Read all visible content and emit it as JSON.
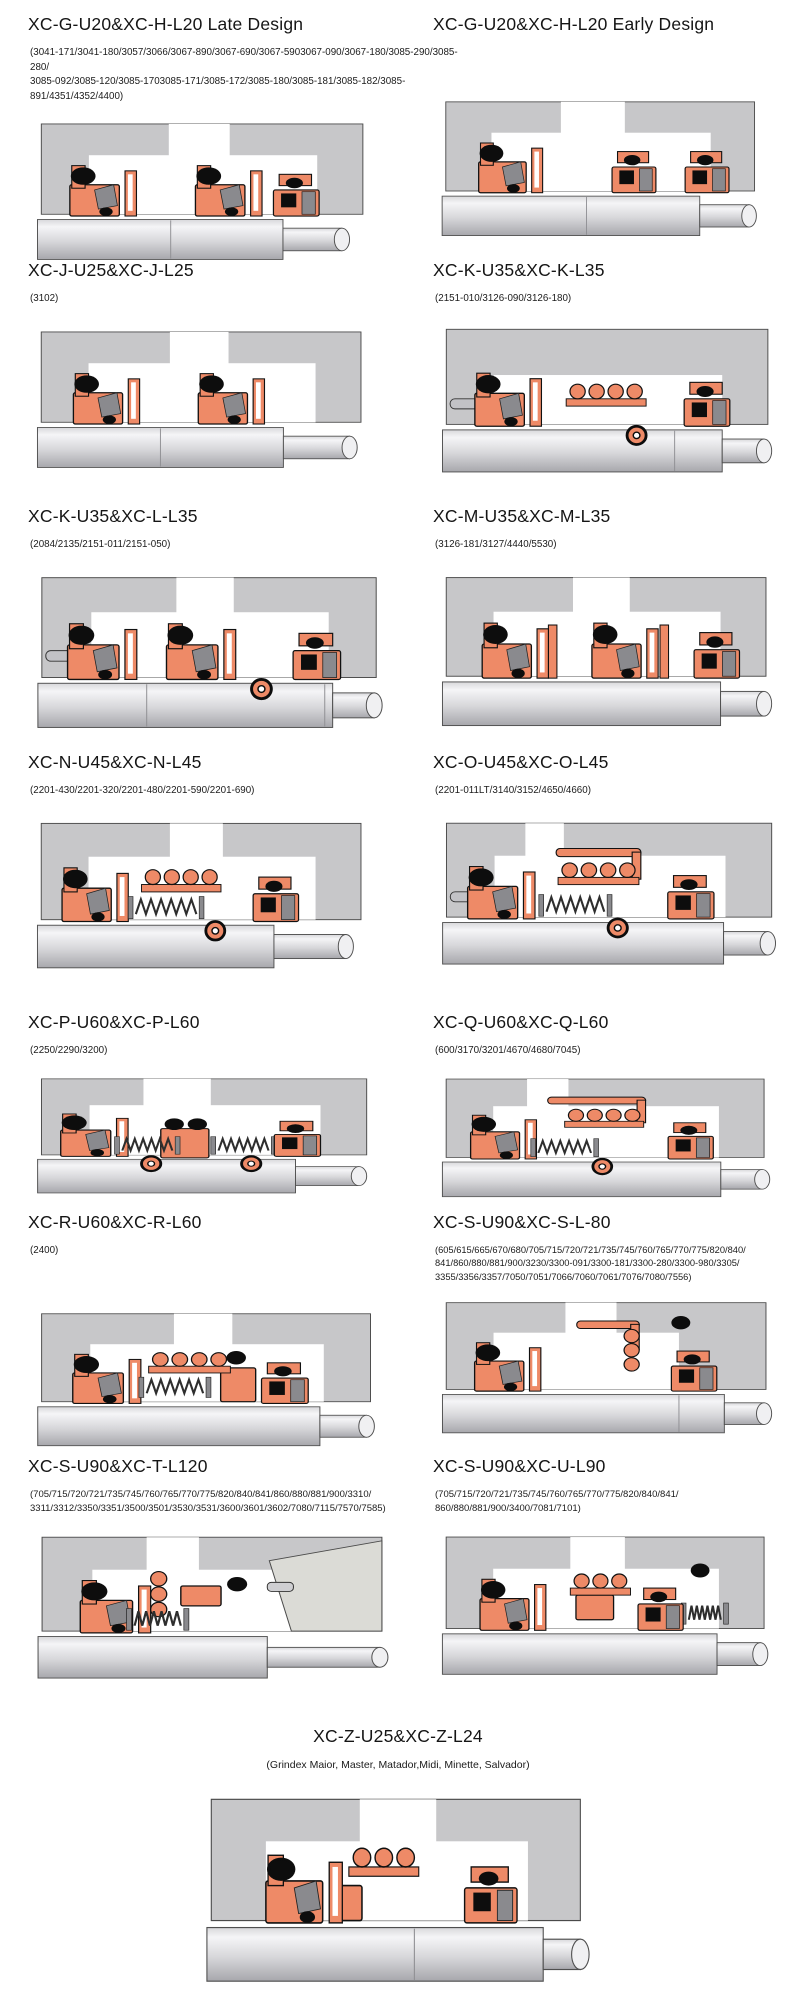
{
  "colors": {
    "housing": "#c7c7c9",
    "seal": "#ee8a67",
    "elastomer": "#0d0d0d",
    "metal": "#8a8a8e",
    "shaft_light": "#f5f5f7",
    "shaft_dark": "#a7a7ac",
    "outline": "#4a4a4a"
  },
  "sections": [
    {
      "title": "XC-G-U20&XC-H-L20 Late Design",
      "parts": "(3041-171/3041-180/3057/3066/3067-890/3067-690/3067-5903067-090/3067-180/3085-290/3085-280/\n3085-092/3085-120/3085-1703085-171/3085-172/3085-180/3085-181/3085-182/3085-891/4351/4352/4400)"
    },
    {
      "title": "XC-G-U20&XC-H-L20 Early Design",
      "parts": ""
    },
    {
      "title": "XC-J-U25&XC-J-L25",
      "parts": "(3102)"
    },
    {
      "title": "XC-K-U35&XC-K-L35",
      "parts": "(2151-010/3126-090/3126-180)"
    },
    {
      "title": "XC-K-U35&XC-L-L35",
      "parts": "(2084/2135/2151-011/2151-050)"
    },
    {
      "title": "XC-M-U35&XC-M-L35",
      "parts": "(3126-181/3127/4440/5530)"
    },
    {
      "title": "XC-N-U45&XC-N-L45",
      "parts": "(2201-430/2201-320/2201-480/2201-590/2201-690)"
    },
    {
      "title": "XC-O-U45&XC-O-L45",
      "parts": "(2201-011LT/3140/3152/4650/4660)"
    },
    {
      "title": "XC-P-U60&XC-P-L60",
      "parts": "(2250/2290/3200)"
    },
    {
      "title": "XC-Q-U60&XC-Q-L60",
      "parts": "(600/3170/3201/4670/4680/7045)"
    },
    {
      "title": "XC-R-U60&XC-R-L60",
      "parts": "(2400)"
    },
    {
      "title": "XC-S-U90&XC-S-L-80",
      "parts": "(605/615/665/670/680/705/715/720/721/735/745/760/765/770/775/820/840/\n841/860/880/881/900/3230/3300-091/3300-181/3300-280/3300-980/3305/\n3355/3356/3357/7050/7051/7066/7060/7061/7076/7080/7556)"
    },
    {
      "title": "XC-S-U90&XC-T-L120",
      "parts": "(705/715/720/721/735/745/760/765/770/775/820/840/841/860/880/881/900/3310/\n3311/3312/3350/3351/3500/3501/3530/3531/3600/3601/3602/7080/7115/7570/7585)"
    },
    {
      "title": "XC-S-U90&XC-U-L90",
      "parts": "(705/715/720/721/735/745/760/765/770/775/820/840/841/\n860/880/881/900/3400/7081/7101)"
    },
    {
      "title": "XC-Z-U25&XC-Z-L24",
      "parts": "(Grindex  Maior, Master, Matador,Midi, Minette, Salvador)"
    }
  ]
}
